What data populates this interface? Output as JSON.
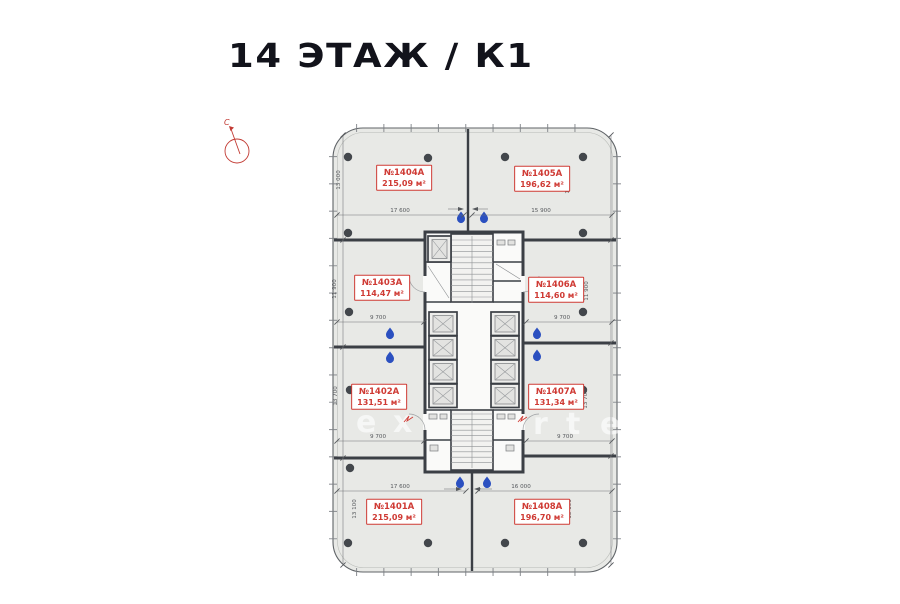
{
  "title": "14 ЭТАЖ / К1",
  "compass": {
    "north_label": "С"
  },
  "units": [
    {
      "id": "1404A",
      "number": "№1404A",
      "area": "215,09 м²",
      "width_dim": "17 600",
      "side_dim": "13 000"
    },
    {
      "id": "1405A",
      "number": "№1405A",
      "area": "196,62 м²",
      "width_dim": "15 900",
      "side_dim": "13 000"
    },
    {
      "id": "1403A",
      "number": "№1403A",
      "area": "114,47 м²",
      "width_dim": "9 700",
      "side_dim": "11 900"
    },
    {
      "id": "1406A",
      "number": "№1406A",
      "area": "114,60 м²",
      "width_dim": "9 700",
      "side_dim": "11 900"
    },
    {
      "id": "1402A",
      "number": "№1402A",
      "area": "131,51 м²",
      "width_dim": "9 700",
      "side_dim": "13 700"
    },
    {
      "id": "1407A",
      "number": "№1407A",
      "area": "131,34 м²",
      "width_dim": "9 700",
      "side_dim": "13 700"
    },
    {
      "id": "1401A",
      "number": "№1401A",
      "area": "215,09 м²",
      "width_dim": "17 600",
      "side_dim": "13 100"
    },
    {
      "id": "1408A",
      "number": "№1408A",
      "area": "196,70 м²",
      "width_dim": "16 000",
      "side_dim": "13 100"
    }
  ],
  "watermark_letters": [
    "e",
    "x",
    "r",
    "t",
    "e"
  ],
  "colors": {
    "red": "#cf3a34",
    "wall": "#3b3f45",
    "fill": "#e8e9e6",
    "drop": "#2b50c0",
    "title": "#12131b",
    "dim": "#54575b"
  }
}
